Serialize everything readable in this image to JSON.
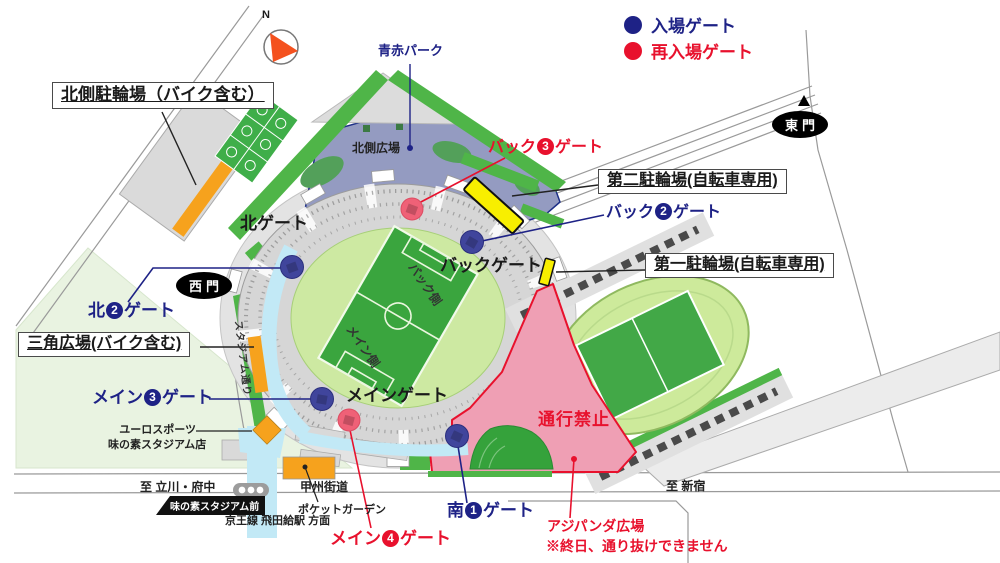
{
  "legend": {
    "entry_label": "入場ゲート",
    "reentry_label": "再入場ゲート"
  },
  "compass": {
    "north": "N"
  },
  "areas": {
    "north_plaza": "北側広場",
    "aoaka_park": "青赤パーク",
    "back_side": "バック側",
    "main_side": "メイン側",
    "no_passage": "通行禁止",
    "ajipanda_line1": "アジパンダ広場",
    "ajipanda_line2": "※終日、通り抜けできません"
  },
  "parking": {
    "north_bike": "北側駐輪場（バイク含む）",
    "bike2": "第二駐輪場(自転車専用)",
    "bike1": "第一駐輪場(自転車専用)",
    "triangle_plaza": "三角広場(バイク含む)"
  },
  "gates": {
    "north_gate": "北ゲート",
    "back_gate": "バックゲート",
    "main_gate": "メインゲート",
    "west_gate": "西門",
    "east_gate": "東門",
    "back3": {
      "pre": "バック",
      "num": "3",
      "post": "ゲート"
    },
    "back2": {
      "pre": "バック",
      "num": "2",
      "post": "ゲート"
    },
    "north2": {
      "pre": "北",
      "num": "2",
      "post": "ゲート"
    },
    "main3": {
      "pre": "メイン",
      "num": "3",
      "post": "ゲート"
    },
    "main4": {
      "pre": "メイン",
      "num": "4",
      "post": "ゲート"
    },
    "south1": {
      "pre": "南",
      "num": "1",
      "post": "ゲート"
    }
  },
  "streets": {
    "stadium_street": "スタジアム通り",
    "koshu_kaido": "甲州街道",
    "to_tachikawa": "至 立川・府中",
    "to_shinjuku": "至 新宿",
    "station": "味の素スタジアム前",
    "keio": "京王線 飛田給駅 方面"
  },
  "places": {
    "eurosport1": "ユーロスポーツ",
    "eurosport2": "味の素スタジアム店",
    "pocket_garden": "ポケットガーデン"
  },
  "colors": {
    "entry_gate": "#1e2286",
    "reentry_gate": "#e8112d",
    "no_passage_zone": "#ef9fb4",
    "green_belt": "#4fb548",
    "walkway_cyan": "#c2e9f6",
    "bicycle_parking_yellow": "#f8ef00",
    "bike_parking_orange": "#f6a21d",
    "north_plaza_blue": "#949bc1"
  }
}
